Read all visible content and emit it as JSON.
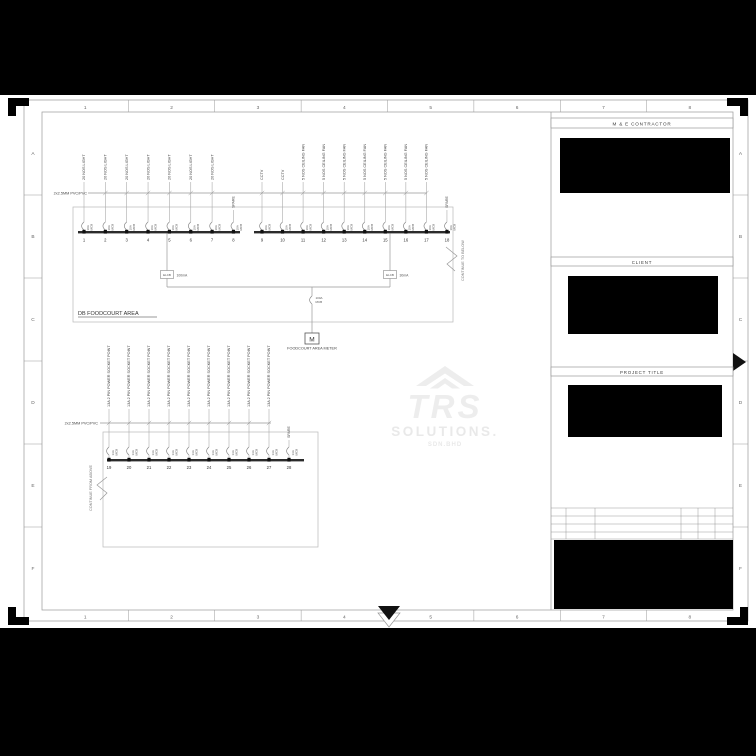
{
  "page": {
    "background": "#000000",
    "sheet_background": "#ffffff",
    "line_color": "#999999",
    "ink_color": "#333333",
    "redaction_color": "#000000"
  },
  "sheet_grid": {
    "columns": [
      "1",
      "2",
      "3",
      "4",
      "5",
      "6",
      "7",
      "8"
    ],
    "rows": [
      "A",
      "B",
      "C",
      "D",
      "E",
      "F"
    ]
  },
  "title_block": {
    "contractor_header": "M & E CONTRACTOR",
    "client_header": "CLIENT",
    "project_header": "PROJECT TITLE"
  },
  "watermark": {
    "brand": "TRS",
    "word": "SOLUTIONS.",
    "suffix": "SDN.BHD",
    "color": "#ededed"
  },
  "schematic": {
    "db_top": {
      "name": "DB FOODCOURT AREA",
      "cable_label": "2x2.5MM PVC/PVC",
      "elcb_left": {
        "device": "ELCB",
        "rating": "100mA"
      },
      "elcb_right": {
        "device": "ELCB",
        "rating": "30mA"
      },
      "main_switch": [
        "100A",
        "MCB"
      ],
      "meter_symbol": "M",
      "meter_label": "FOODCOURT AREA METER",
      "continue_note": "CONTINUE TO BELOW",
      "circuits": [
        {
          "no": "1",
          "load": "20 NOS LIGHT",
          "breaker": [
            "10A",
            "MCB"
          ]
        },
        {
          "no": "2",
          "load": "20 NOS LIGHT",
          "breaker": [
            "10A",
            "MCB"
          ]
        },
        {
          "no": "3",
          "load": "20 NOS LIGHT",
          "breaker": [
            "10A",
            "MCB"
          ]
        },
        {
          "no": "4",
          "load": "20 NOS LIGHT",
          "breaker": [
            "10A",
            "MCB"
          ]
        },
        {
          "no": "5",
          "load": "20 NOS LIGHT",
          "breaker": [
            "10A",
            "MCB"
          ]
        },
        {
          "no": "6",
          "load": "20 NOS LIGHT",
          "breaker": [
            "10A",
            "MCB"
          ]
        },
        {
          "no": "7",
          "load": "20 NOS LIGHT",
          "breaker": [
            "10A",
            "MCB"
          ]
        },
        {
          "no": "8",
          "load": "SPARE",
          "breaker": [
            "10A",
            "MCB"
          ]
        },
        {
          "no": "9",
          "load": "CCTV",
          "breaker": [
            "10A",
            "MCB"
          ]
        },
        {
          "no": "10",
          "load": "CCTV",
          "breaker": [
            "10A",
            "MCB"
          ]
        },
        {
          "no": "11",
          "load": "5 NOS CEILING FAN",
          "breaker": [
            "10A",
            "MCB"
          ]
        },
        {
          "no": "12",
          "load": "5 NOS CEILING FAN",
          "breaker": [
            "10A",
            "MCB"
          ]
        },
        {
          "no": "13",
          "load": "5 NOS CEILING FAN",
          "breaker": [
            "10A",
            "MCB"
          ]
        },
        {
          "no": "14",
          "load": "5 NOS CEILING FAN",
          "breaker": [
            "10A",
            "MCB"
          ]
        },
        {
          "no": "15",
          "load": "5 NOS CEILING FAN",
          "breaker": [
            "10A",
            "MCB"
          ]
        },
        {
          "no": "16",
          "load": "5 NOS CEILING FAN",
          "breaker": [
            "10A",
            "MCB"
          ]
        },
        {
          "no": "17",
          "load": "5 NOS CEILING FAN",
          "breaker": [
            "10A",
            "MCB"
          ]
        },
        {
          "no": "18",
          "load": "SPARE",
          "breaker": [
            "10A",
            "MCB"
          ]
        }
      ]
    },
    "db_bottom": {
      "cable_label": "2x2.5MM PVC/PVC",
      "continue_note": "CONTINUE FROM ABOVE",
      "circuits": [
        {
          "no": "19",
          "load": "13A 2 PIN POWER SOCKET POINT",
          "breaker": [
            "13A",
            "MCB"
          ]
        },
        {
          "no": "20",
          "load": "13A 2 PIN POWER SOCKET POINT",
          "breaker": [
            "13A",
            "MCB"
          ]
        },
        {
          "no": "21",
          "load": "13A 2 PIN POWER SOCKET POINT",
          "breaker": [
            "13A",
            "MCB"
          ]
        },
        {
          "no": "22",
          "load": "13A 2 PIN POWER SOCKET POINT",
          "breaker": [
            "13A",
            "MCB"
          ]
        },
        {
          "no": "23",
          "load": "13A 2 PIN POWER SOCKET POINT",
          "breaker": [
            "13A",
            "MCB"
          ]
        },
        {
          "no": "24",
          "load": "13A 2 PIN POWER SOCKET POINT",
          "breaker": [
            "13A",
            "MCB"
          ]
        },
        {
          "no": "25",
          "load": "13A 2 PIN POWER SOCKET POINT",
          "breaker": [
            "13A",
            "MCB"
          ]
        },
        {
          "no": "26",
          "load": "13A 2 PIN POWER SOCKET POINT",
          "breaker": [
            "13A",
            "MCB"
          ]
        },
        {
          "no": "27",
          "load": "13A 2 PIN POWER SOCKET POINT",
          "breaker": [
            "13A",
            "MCB"
          ]
        },
        {
          "no": "28",
          "load": "SPARE",
          "breaker": [
            "13A",
            "MCB"
          ]
        }
      ]
    }
  }
}
